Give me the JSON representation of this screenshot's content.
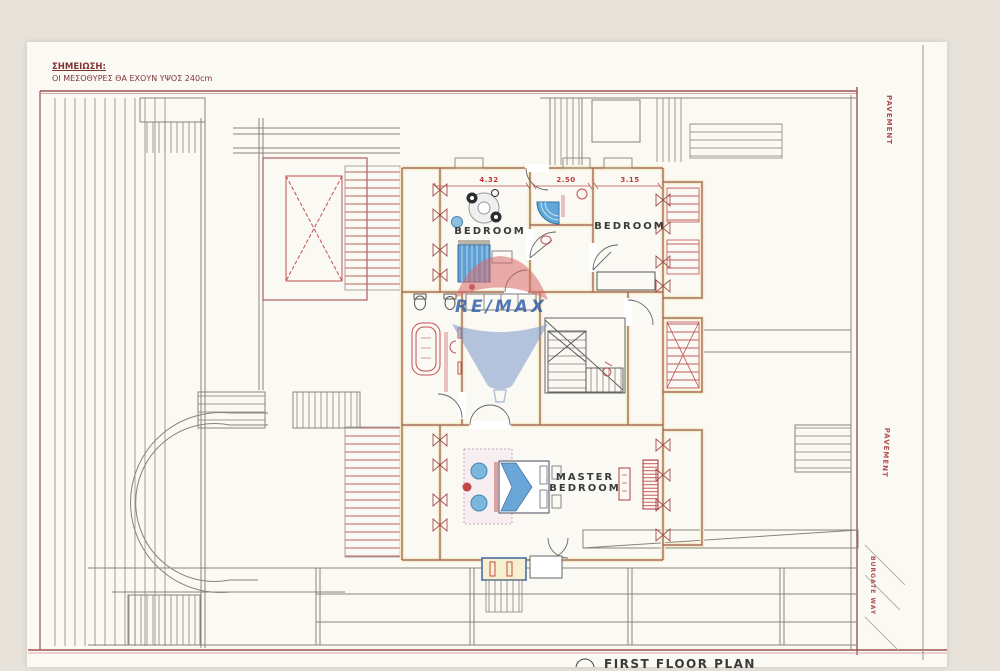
{
  "note": {
    "title": "ΣΗΜΕΙΩΣΗ:",
    "body": "ΟΙ ΜΕΣΟΘΥΡΕΣ ΘΑ ΕΧΟΥΝ ΥΨΟΣ 240cm"
  },
  "rooms": {
    "bedroom_left": "BEDROOM",
    "bedroom_right": "BEDROOM",
    "master_line1": "MASTER",
    "master_line2": "BEDROOM"
  },
  "dimensions": {
    "left": "4.32",
    "middle": "2.50",
    "right": "3.15"
  },
  "annotations": {
    "pavement_upper": "PAVEMENT",
    "pavement_lower": "PAVEMENT",
    "street": "BURGATE WAY",
    "caption": "FIRST FLOOR PLAN"
  },
  "watermark": {
    "brand": "RE/MAX"
  },
  "colors": {
    "background": "#e8e3da",
    "paper": "#fbf9f4",
    "wall_fill": "#f3edc6",
    "wall_line": "#9b5252",
    "gray_line": "#8b8279",
    "fixture_red": "#c04848",
    "furniture_blue": "#5b9bd0",
    "dim_text": "#c03a3a",
    "watermark_blue": "#2a5aa8",
    "watermark_red": "#d96a6a"
  }
}
